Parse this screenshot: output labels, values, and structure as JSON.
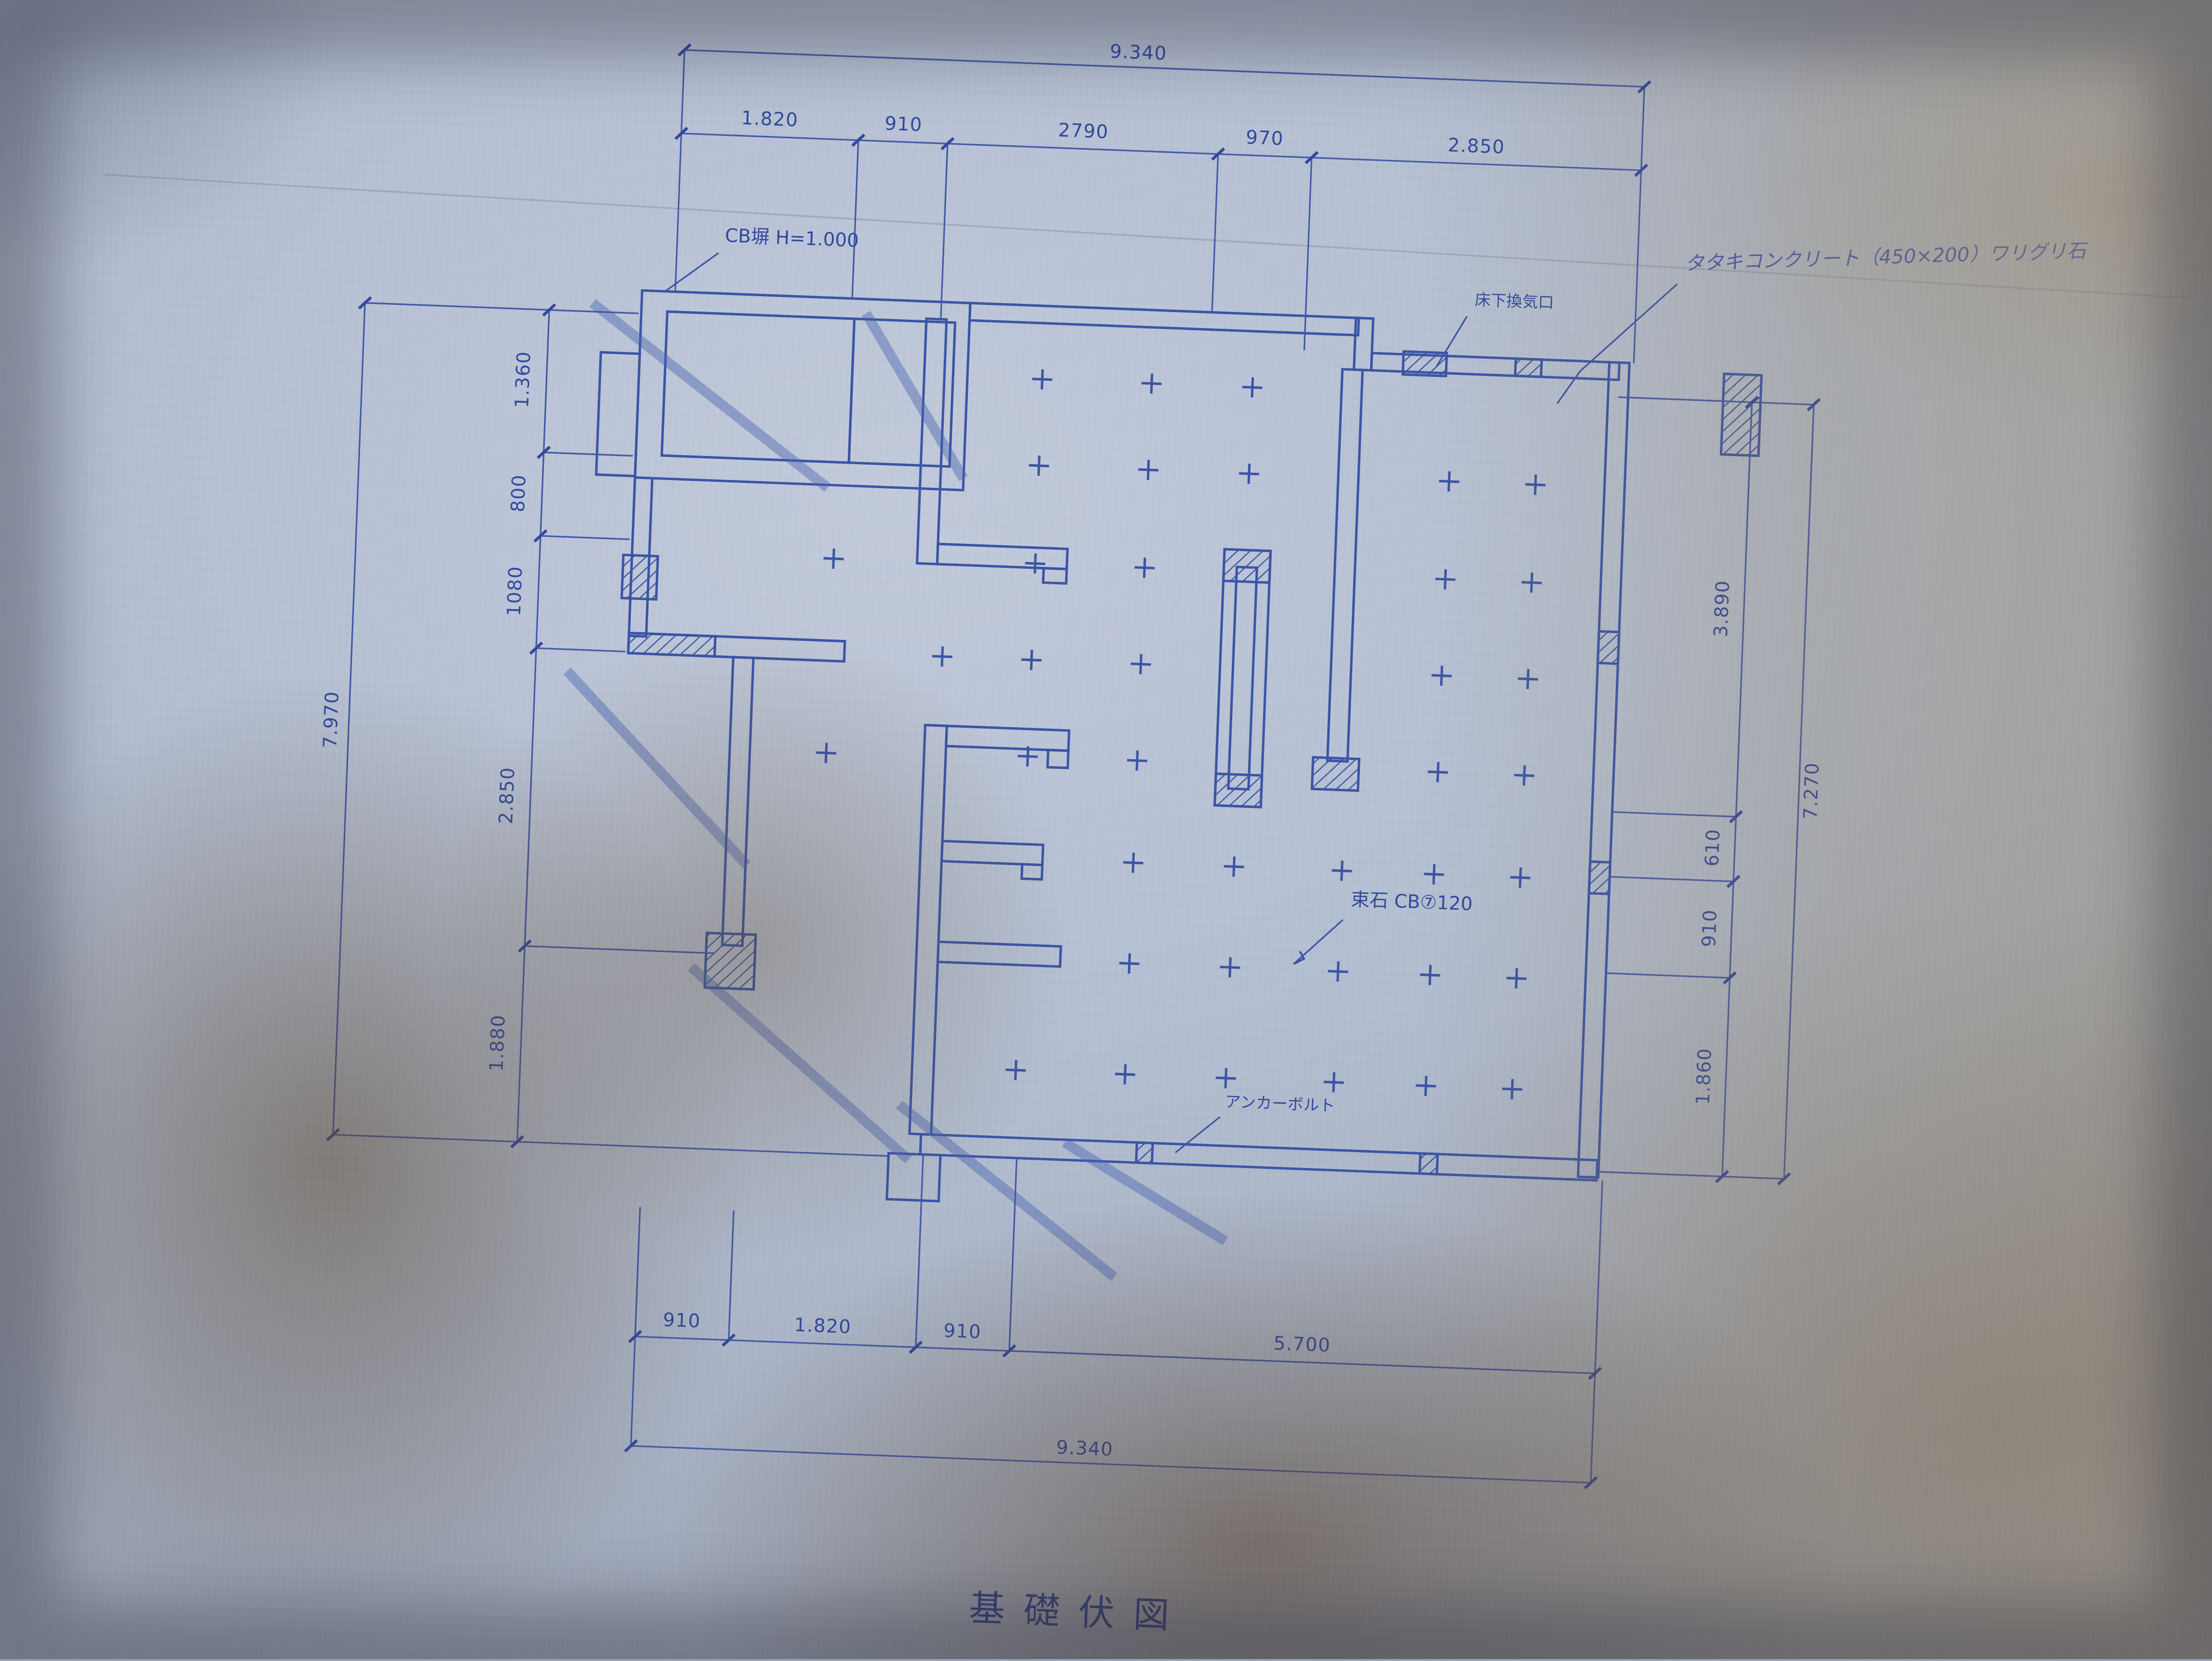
{
  "document": {
    "type": "architectural-blueprint-photo",
    "drawing_kind": "foundation plan",
    "title": "基礎伏図"
  },
  "annotations": {
    "cb_wall": "CB塀 H=1.000",
    "vent": "床下換気口",
    "concrete": "タタキコンクリート（450×200）ワリグリ石",
    "tsukaishi": "束石 CB⑦120",
    "anchor": "アンカーボルト"
  },
  "dimensions": {
    "top_total": "9.340",
    "top_segments": [
      "1.820",
      "910",
      "2790",
      "970",
      "2.850"
    ],
    "left_total": "7.970",
    "left_segments": [
      "1.360",
      "800",
      "1080",
      "2.850",
      "1.880"
    ],
    "right_total": "7.270",
    "right_segments": [
      "3.890",
      "610",
      "910",
      "1.860"
    ],
    "bottom_segments": [
      "910",
      "1.820",
      "910",
      "5.700"
    ],
    "bottom_total": "9.340"
  },
  "colors": {
    "ink": "#3a54a6",
    "paper": "#b6c0d2",
    "shadow": "#5c4830"
  }
}
